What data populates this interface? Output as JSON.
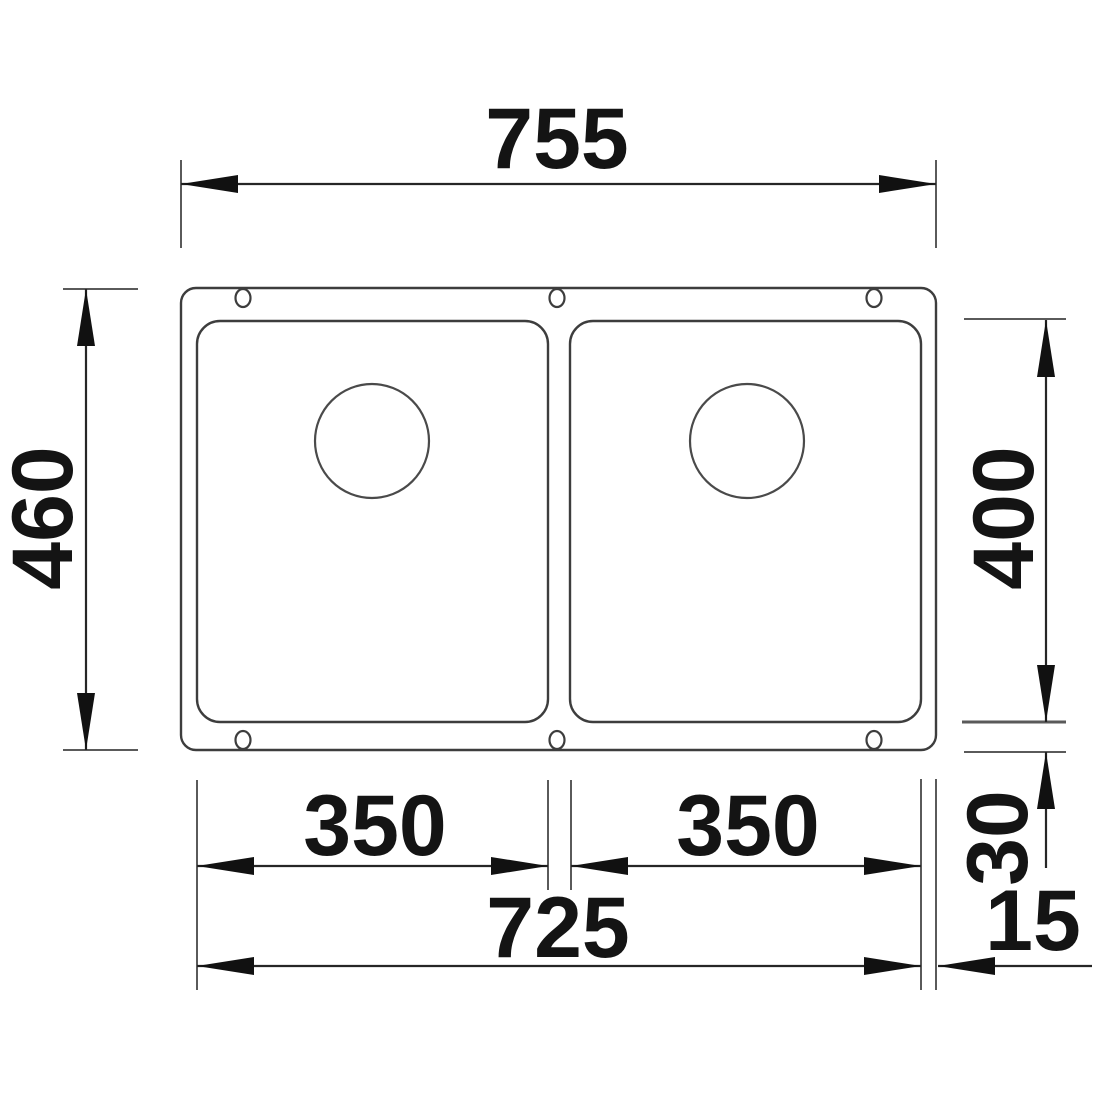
{
  "drawing": {
    "kind": "technical dimension drawing",
    "subject": "double-bowl undermount kitchen sink, top view",
    "units": "mm",
    "colors": {
      "outline": "#3d3d3d",
      "drain_outline": "#4a4a4a",
      "dimension_line": "#262626",
      "extension_line": "#5a5a5a",
      "arrow_fill": "#111111",
      "text": "#141414",
      "background": "#ffffff"
    },
    "dimensions": {
      "overall_width": "755",
      "overall_depth": "460",
      "bowl_depth": "400",
      "bowl_width_left": "350",
      "bowl_width_right": "350",
      "cutout_width": "725",
      "rim_bottom": "30",
      "rim_side": "15"
    }
  }
}
